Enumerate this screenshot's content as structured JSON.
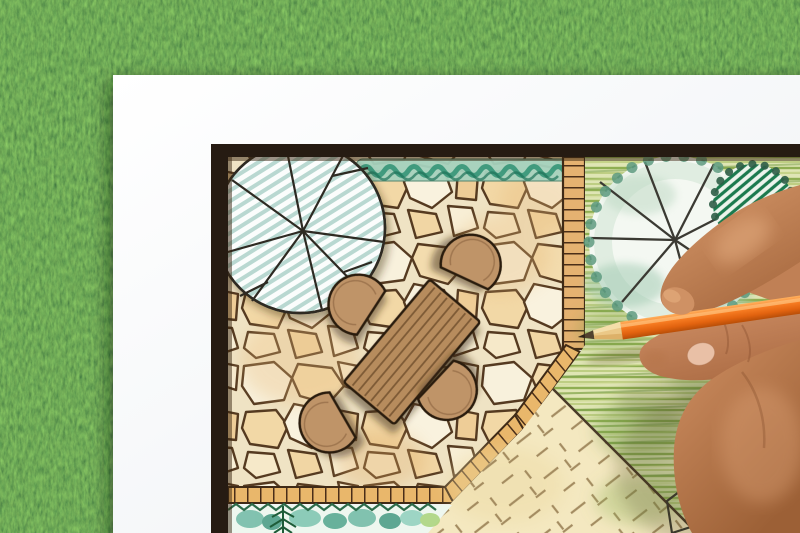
{
  "scene": {
    "description": "Close-up photograph of a hand holding an orange colored pencil while drawing a garden landscape design plan on a white sheet of paper that lies on green grass",
    "background": {
      "label": "green grass lawn",
      "base_color": "#4c7a41"
    },
    "paper": {
      "label": "white paper sheet",
      "color": "#f7f8fa"
    },
    "plan": {
      "label": "hand-drawn garden landscape plan",
      "frame_color": "#261b12",
      "areas": [
        {
          "name": "flagstone-patio",
          "colors": [
            "#f8f1dc",
            "#eec58f",
            "#553a20"
          ]
        },
        {
          "name": "round-shade-tree-striped-canopy",
          "colors": [
            "#b9d8d1",
            "#2e2a24"
          ]
        },
        {
          "name": "clipped-hedge-strip",
          "colors": [
            "#a6d2bd",
            "#2f9273"
          ]
        },
        {
          "name": "wooden-boardwalk",
          "color": "#e5b271"
        },
        {
          "name": "brick-edging",
          "color": "#e9b76b"
        },
        {
          "name": "wooden-dining-table",
          "color": "#b78c5d"
        },
        {
          "name": "patio-chairs",
          "count": 4,
          "color": "#bf9468"
        },
        {
          "name": "hatched-lawn",
          "colors": [
            "#8fae52",
            "#dfe5b4"
          ]
        },
        {
          "name": "scalloped-canopy-tree",
          "colors": [
            "#5d9a7f",
            "#3b3a33"
          ]
        },
        {
          "name": "striped-evergreen-shrub",
          "color": "#1c7a4e"
        },
        {
          "name": "groundcover-cross-hatched",
          "colors": [
            "#f4e8c0",
            "#9b8257"
          ]
        },
        {
          "name": "waterside-planting-bed",
          "colors": [
            "#6fb9a4",
            "#1e5c38"
          ]
        },
        {
          "name": "corner-planting-bed",
          "colors": [
            "#7ab060",
            "#cf5a28"
          ]
        }
      ]
    },
    "hand": {
      "label": "hand holding pencil",
      "skin_color": "#c98a5f"
    },
    "pencil": {
      "label": "orange colored pencil",
      "body_color": "#f07320",
      "wood_color": "#ebc887",
      "lead_color": "#52422f"
    }
  }
}
